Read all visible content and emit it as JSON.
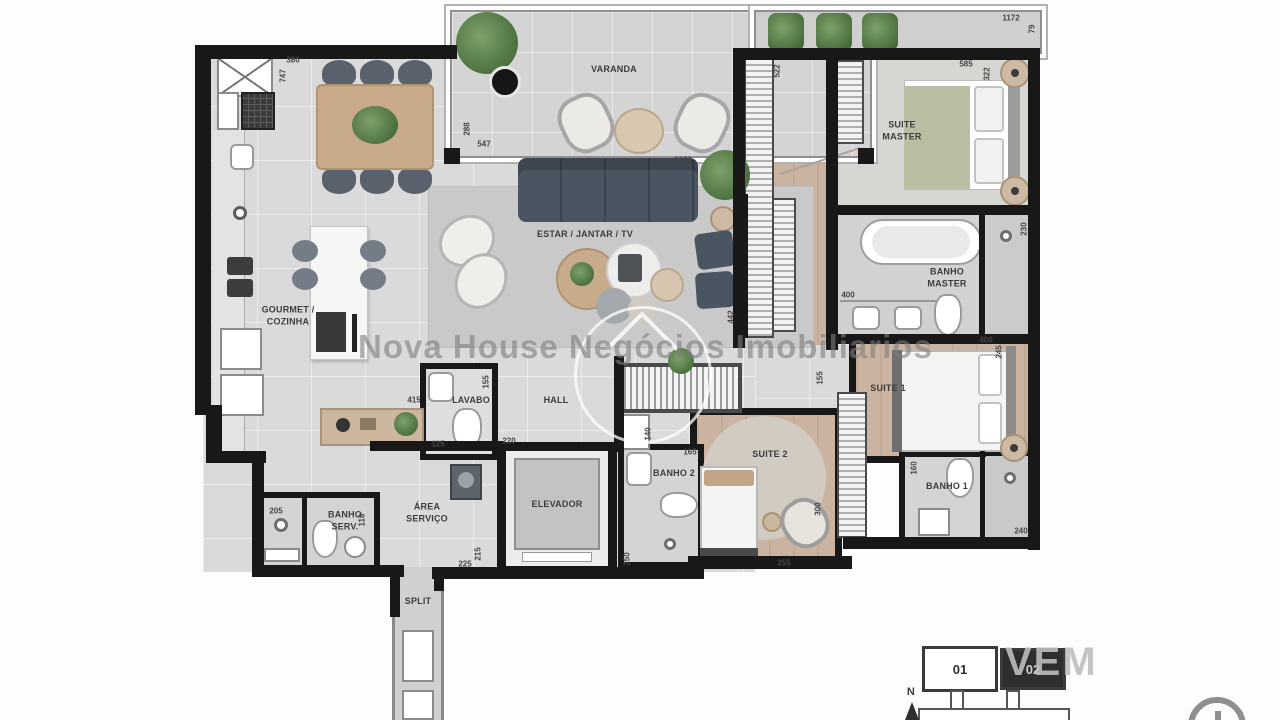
{
  "watermark": {
    "brand": "Nova House Negócios Imobiliarios",
    "overlay": "VEM"
  },
  "rooms": {
    "varanda": {
      "label": "VARANDA"
    },
    "suite_master": {
      "label": "SUITE MASTER"
    },
    "banho_master": {
      "label": "BANHO MASTER"
    },
    "gourmet": {
      "label": "GOURMET / COZINHA"
    },
    "estar": {
      "label": "ESTAR / JANTAR / TV"
    },
    "lavabo": {
      "label": "LAVABO"
    },
    "hall": {
      "label": "HALL"
    },
    "elevador": {
      "label": "ELEVADOR"
    },
    "banho2": {
      "label": "BANHO 2"
    },
    "suite2": {
      "label": "SUITE 2"
    },
    "suite1": {
      "label": "SUITE 1"
    },
    "banho1": {
      "label": "BANHO 1"
    },
    "area_servico": {
      "label": "ÁREA SERVIÇO"
    },
    "banho_serv": {
      "label": "BANHO SERV."
    },
    "split": {
      "label": "SPLIT"
    }
  },
  "keyplan": {
    "unit_01": "01",
    "unit_02": "02",
    "north": "N"
  },
  "measurements": [
    {
      "v": "380",
      "x": 293,
      "y": 60
    },
    {
      "v": "747",
      "x": 283,
      "y": 76,
      "r": 1
    },
    {
      "v": "288",
      "x": 467,
      "y": 129,
      "r": 1
    },
    {
      "v": "547",
      "x": 484,
      "y": 144
    },
    {
      "v": "1070",
      "x": 683,
      "y": 160
    },
    {
      "v": "1172",
      "x": 1011,
      "y": 18
    },
    {
      "v": "79",
      "x": 1032,
      "y": 29,
      "r": 1
    },
    {
      "v": "585",
      "x": 966,
      "y": 64
    },
    {
      "v": "322",
      "x": 987,
      "y": 74,
      "r": 1
    },
    {
      "v": "522",
      "x": 777,
      "y": 71,
      "r": 1
    },
    {
      "v": "400",
      "x": 848,
      "y": 295
    },
    {
      "v": "230",
      "x": 1024,
      "y": 229,
      "r": 1
    },
    {
      "v": "400",
      "x": 986,
      "y": 340
    },
    {
      "v": "245",
      "x": 999,
      "y": 352,
      "r": 1
    },
    {
      "v": "442",
      "x": 731,
      "y": 317,
      "r": 1
    },
    {
      "v": "155",
      "x": 820,
      "y": 378,
      "r": 1
    },
    {
      "v": "165",
      "x": 690,
      "y": 452
    },
    {
      "v": "140",
      "x": 648,
      "y": 434,
      "r": 1
    },
    {
      "v": "250",
      "x": 627,
      "y": 559,
      "r": 1
    },
    {
      "v": "255",
      "x": 784,
      "y": 563
    },
    {
      "v": "300",
      "x": 818,
      "y": 509,
      "r": 1
    },
    {
      "v": "160",
      "x": 914,
      "y": 468,
      "r": 1
    },
    {
      "v": "240",
      "x": 1021,
      "y": 531
    },
    {
      "v": "415",
      "x": 414,
      "y": 400
    },
    {
      "v": "155",
      "x": 486,
      "y": 382,
      "r": 1
    },
    {
      "v": "125",
      "x": 438,
      "y": 444
    },
    {
      "v": "220",
      "x": 509,
      "y": 441
    },
    {
      "v": "225",
      "x": 465,
      "y": 564
    },
    {
      "v": "215",
      "x": 478,
      "y": 554,
      "r": 1
    },
    {
      "v": "205",
      "x": 276,
      "y": 511
    },
    {
      "v": "116",
      "x": 362,
      "y": 520,
      "r": 1
    }
  ],
  "colors": {
    "wall": "#181818",
    "social_floor": "#dadada",
    "wood_floor": "#cab4a1",
    "bath_floor": "#d4d4d4",
    "sofa": "#4a5562",
    "master_blanket": "#b8bfa3",
    "unit_highlight": "#2e2e2e",
    "watermark_gray": "#7d7d7d"
  }
}
